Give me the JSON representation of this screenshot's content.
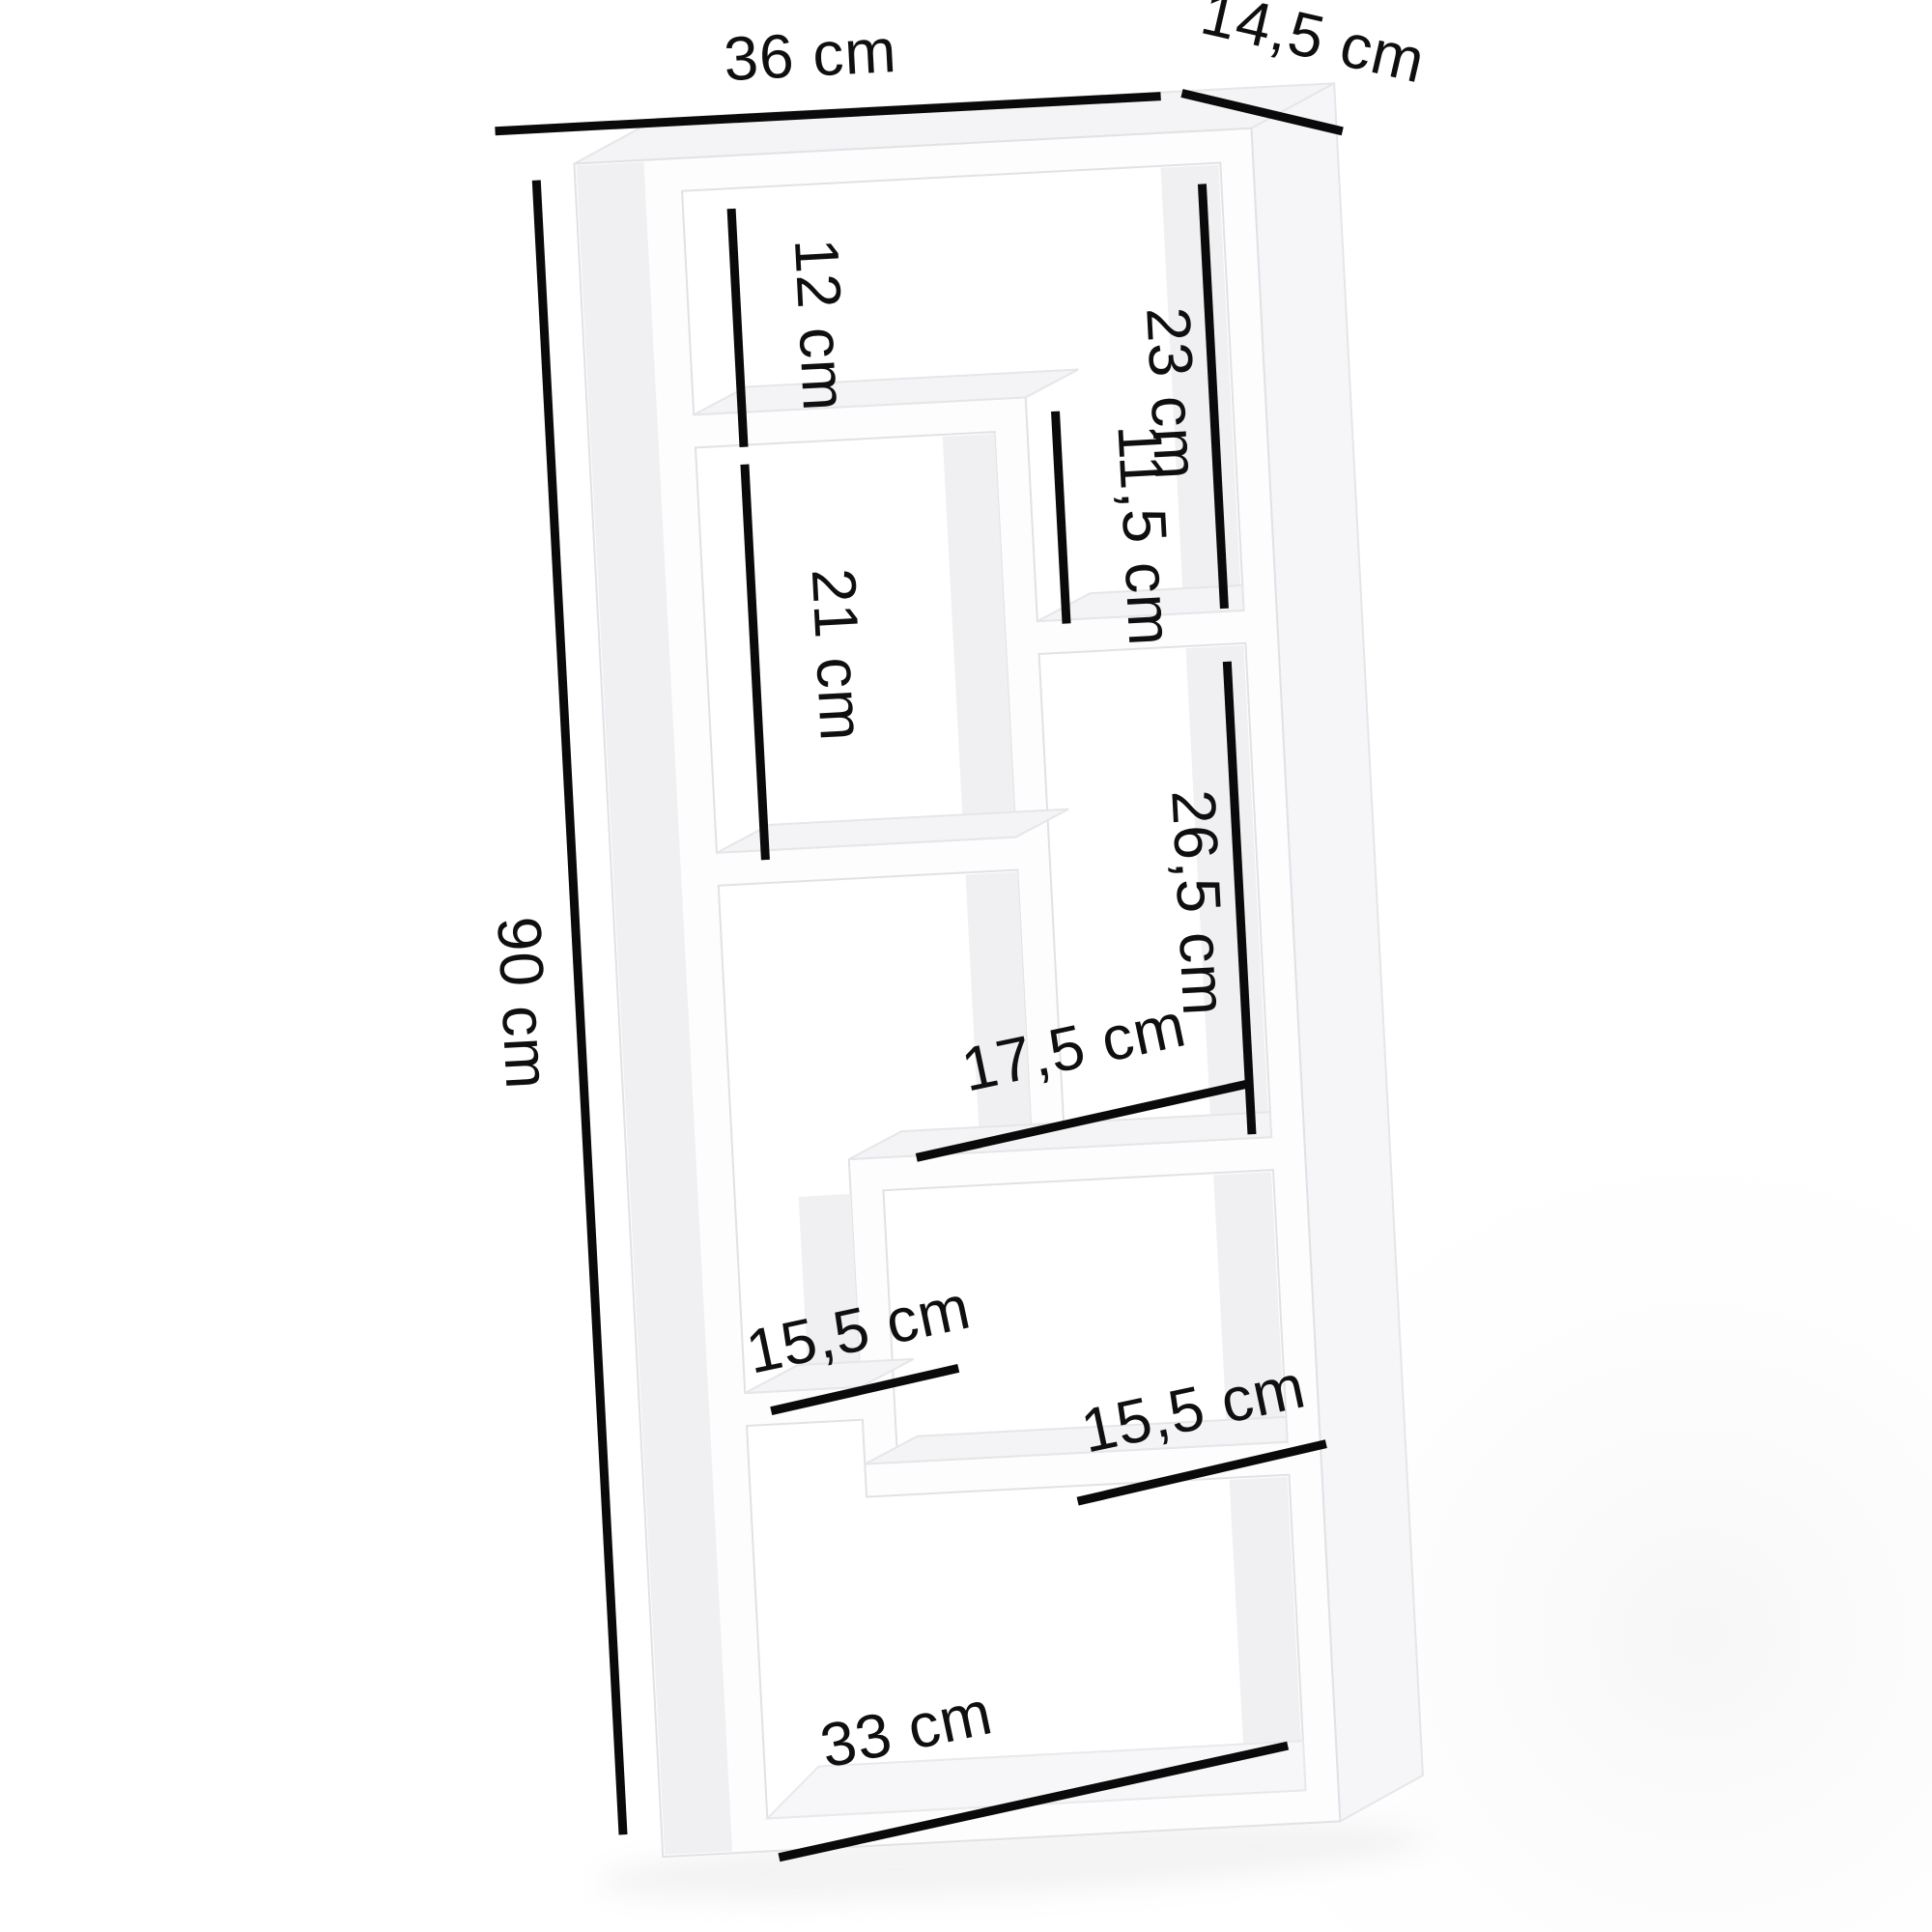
{
  "page": {
    "type": "product dimension diagram",
    "subject": "white staggered wall-mounted shelf with six compartments",
    "background": "#ffffff",
    "unit": "cm"
  },
  "colors": {
    "board_front": "#fdfdfe",
    "board_top_face": "#f4f4f6",
    "board_side_face": "#f6f6f8",
    "board_inner_flank": "#f0f0f3",
    "dimension_line": "#0a0a0a",
    "label_text": "#0f0f0f"
  },
  "dimensions": {
    "width_top": {
      "label": "36 cm",
      "value": 36,
      "unit": "cm",
      "orientation": "horizontal",
      "location": "overall width, above top board"
    },
    "depth_top": {
      "label": "14,5 cm",
      "value": 14.5,
      "unit": "cm",
      "orientation": "diagonal",
      "location": "depth, top right receding edge"
    },
    "height_left": {
      "label": "90 cm",
      "value": 90,
      "unit": "cm",
      "orientation": "vertical",
      "location": "overall height, left side"
    },
    "box_top_left": {
      "label": "12 cm",
      "value": 12,
      "unit": "cm",
      "orientation": "vertical",
      "location": "height of top-left compartment"
    },
    "box_top_right": {
      "label": "23 cm",
      "value": 23,
      "unit": "cm",
      "orientation": "vertical",
      "location": "height of top-right compartment"
    },
    "middle_step": {
      "label": "11,5 cm",
      "value": 11.5,
      "unit": "cm",
      "orientation": "vertical",
      "location": "height of middle step between upper shelves"
    },
    "box_mid_left": {
      "label": "21 cm",
      "value": 21,
      "unit": "cm",
      "orientation": "vertical",
      "location": "height of middle-left compartment"
    },
    "box_mid_right": {
      "label": "26,5 cm",
      "value": 26.5,
      "unit": "cm",
      "orientation": "vertical",
      "location": "height of middle-right compartment"
    },
    "shelf_mid_width": {
      "label": "17,5 cm",
      "value": 17.5,
      "unit": "cm",
      "orientation": "horizontal",
      "location": "width of middle-right shelf"
    },
    "shelf_left_width": {
      "label": "15,5 cm",
      "value": 15.5,
      "unit": "cm",
      "orientation": "horizontal",
      "location": "width of lower-left shelf"
    },
    "shelf_right_width": {
      "label": "15,5 cm",
      "value": 15.5,
      "unit": "cm",
      "orientation": "horizontal",
      "location": "width of lower-right shelf"
    },
    "bottom_inner_width": {
      "label": "33 cm",
      "value": 33,
      "unit": "cm",
      "orientation": "horizontal",
      "location": "inner width at bottom board"
    }
  }
}
